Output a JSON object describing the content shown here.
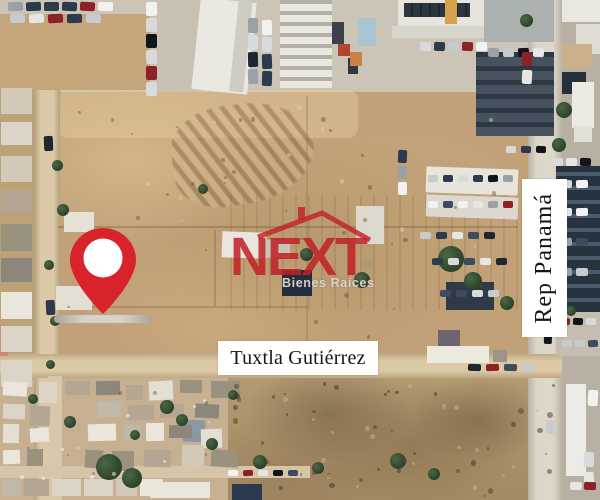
{
  "map_labels": {
    "street_horizontal": "Tuxtla Gutiérrez",
    "street_vertical": "Rep Panamá"
  },
  "watermark": {
    "brand": "NEXT",
    "registered_mark": "®",
    "tagline": "Bienes Raíces",
    "brand_color": "#c2232b",
    "tagline_color": "#ddd8d0"
  },
  "marker": {
    "icon": "location-pin-icon",
    "color": "#d8232a",
    "inner_color": "#ffffff"
  }
}
